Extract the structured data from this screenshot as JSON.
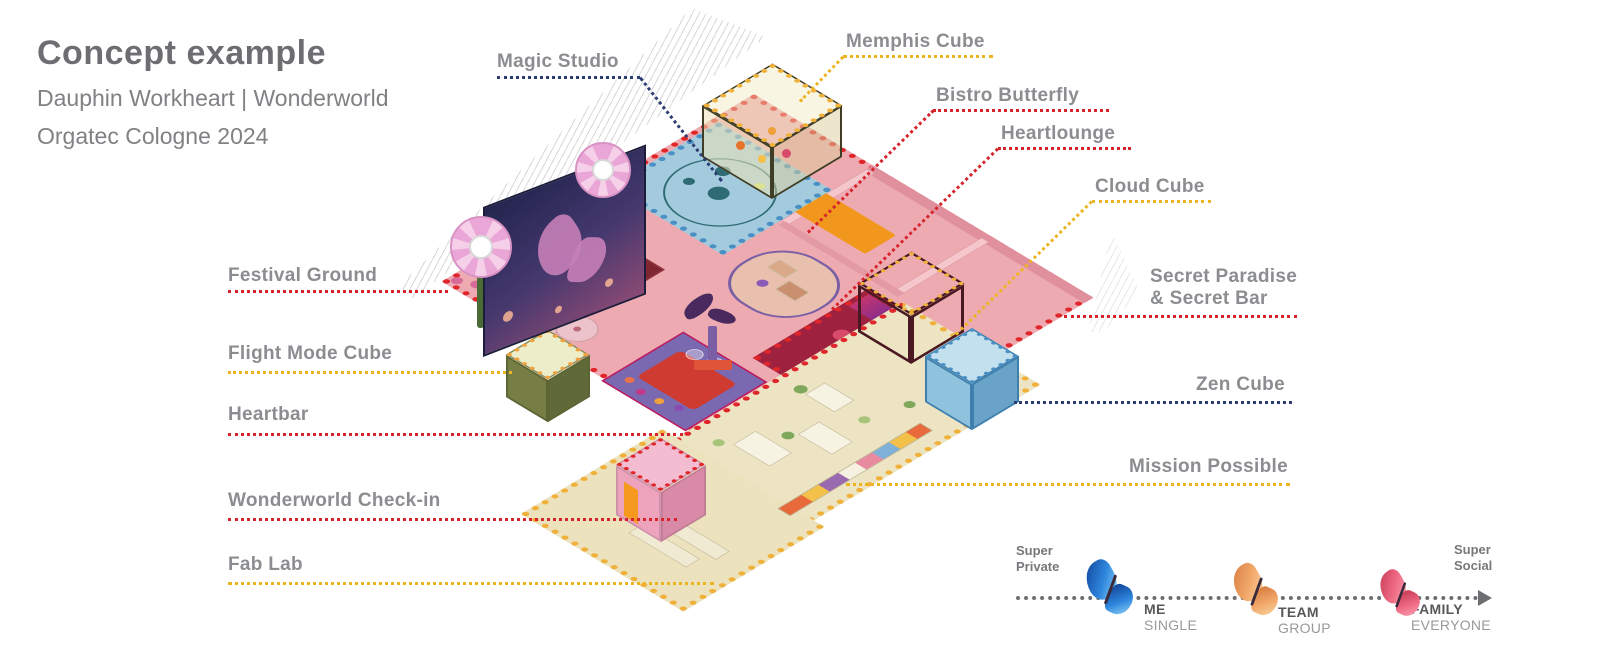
{
  "title": {
    "heading": "Concept example",
    "subtitle_line1": "Dauphin Workheart | Wonderworld",
    "subtitle_line2": "Orgatec Cologne 2024"
  },
  "labels": [
    {
      "text": "Magic Studio",
      "category_color": "navy"
    },
    {
      "text": "Memphis Cube",
      "category_color": "yellow"
    },
    {
      "text": "Bistro Butterfly",
      "category_color": "red"
    },
    {
      "text": "Heartlounge",
      "category_color": "red"
    },
    {
      "text": "Cloud Cube",
      "category_color": "yellow"
    },
    {
      "text": "Secret Paradise\n& Secret Bar",
      "category_color": "red"
    },
    {
      "text": "Zen Cube",
      "category_color": "navy"
    },
    {
      "text": "Mission Possible",
      "category_color": "yellow"
    },
    {
      "text": "Festival Ground",
      "category_color": "red"
    },
    {
      "text": "Flight Mode Cube",
      "category_color": "yellow"
    },
    {
      "text": "Heartbar",
      "category_color": "red"
    },
    {
      "text": "Wonderworld Check-in",
      "category_color": "red"
    },
    {
      "text": "Fab Lab",
      "category_color": "yellow"
    }
  ],
  "legend": {
    "scale_start": "Super\nPrivate",
    "scale_end": "Super\nSocial",
    "stops": [
      {
        "label": "ME",
        "sublabel": "SINGLE",
        "butterfly": "blue"
      },
      {
        "label": "TEAM",
        "sublabel": "GROUP",
        "butterfly": "orange"
      },
      {
        "label": "FAMILY",
        "sublabel": "EVERYONE",
        "butterfly": "pink"
      }
    ]
  },
  "colors": {
    "leader_red": "#d6242c",
    "leader_yellow": "#edb421",
    "leader_navy": "#2b3d73",
    "label_gray": "#8b8d90",
    "title_gray": "#6d6e71",
    "pink_floor": "#edabb1",
    "tan_floor": "#ede4c3",
    "maroon_floor": "#9e2240",
    "blue_zone": "#9acfe2",
    "legend_gray": "#6d6e71"
  }
}
